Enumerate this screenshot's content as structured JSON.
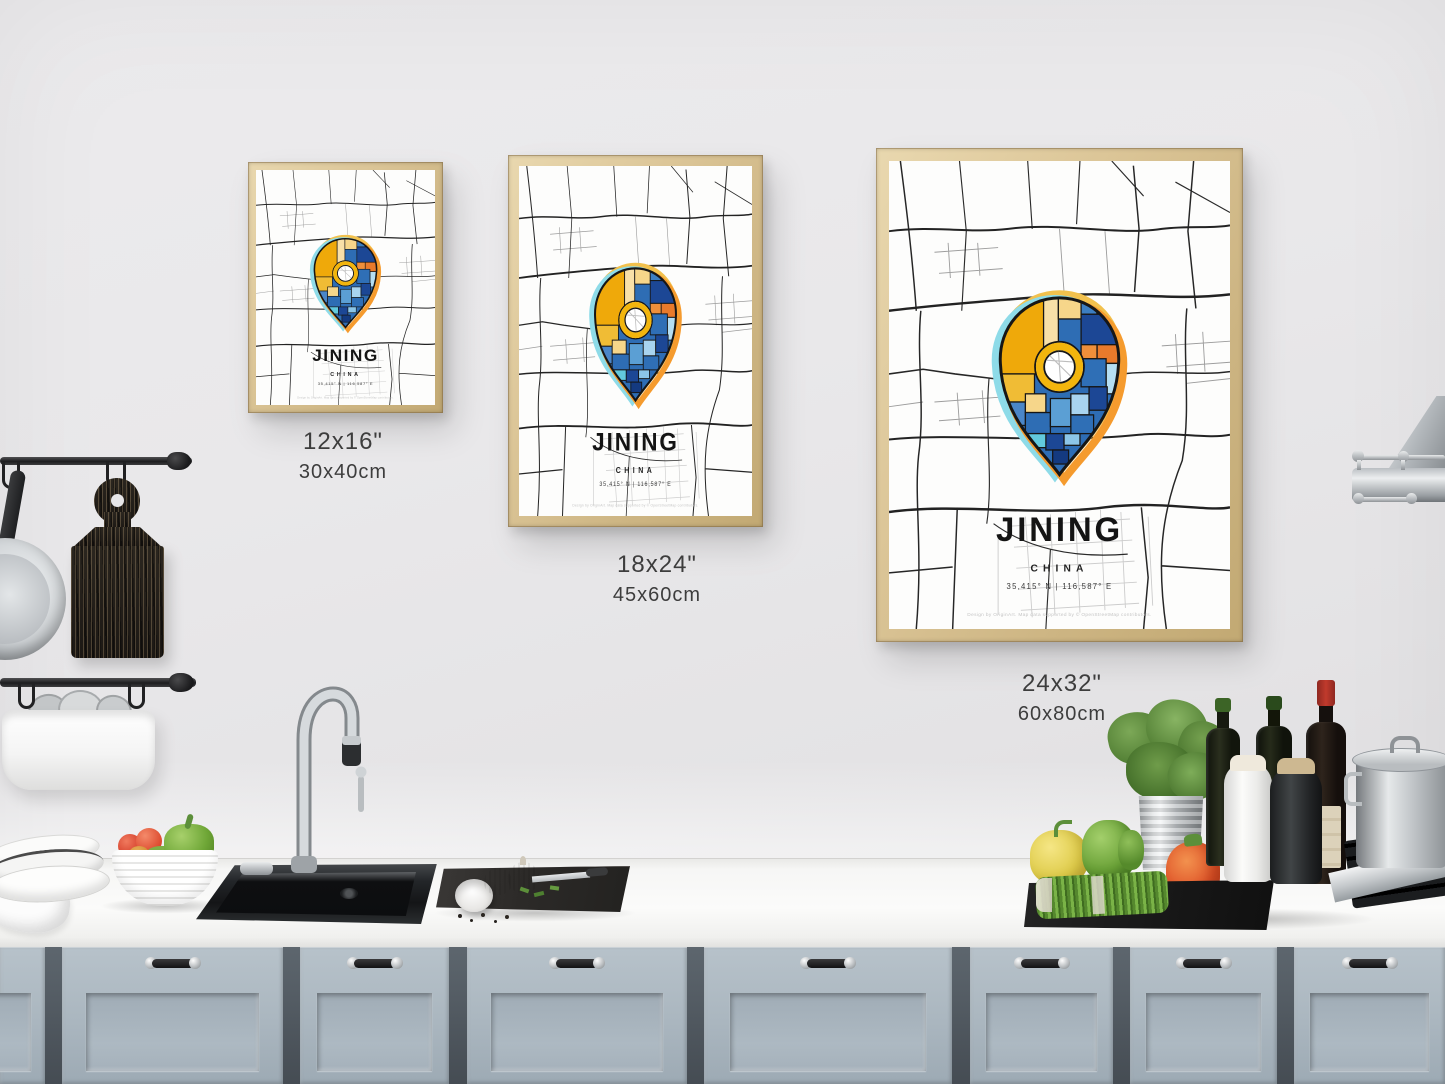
{
  "poster": {
    "title": "JINING",
    "country": "CHINA",
    "coordinates": "35,415° N | 116,587° E",
    "credit": "Design by OriginArt. Map data supported by © OpenStreetMap contributors."
  },
  "size_labels": [
    {
      "inches": "12x16\"",
      "cm": "30x40cm"
    },
    {
      "inches": "18x24\"",
      "cm": "45x60cm"
    },
    {
      "inches": "24x32\"",
      "cm": "60x80cm"
    }
  ],
  "colors": {
    "pin_yellow": "#efa90a",
    "pin_cream": "#f6d68a",
    "pin_orange": "#e87a2b",
    "pin_blue": "#2e6db4",
    "pin_blue_dark": "#1c4795",
    "pin_blue_light": "#a8d4ef",
    "pin_cyan": "#62cade",
    "halo_cyan": "#8edbe8",
    "halo_orange": "#f59b2e",
    "frame_wood": "#d9c392",
    "cabinet_blue_gray": "#aab6bf",
    "wall_gray": "#e8e7e9"
  }
}
